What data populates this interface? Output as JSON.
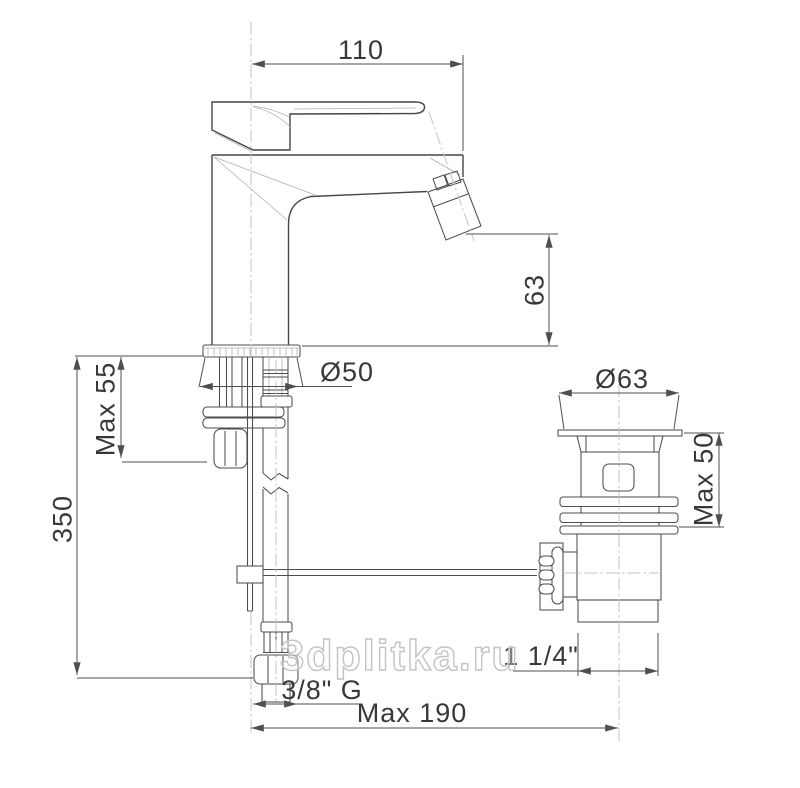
{
  "drawing": {
    "type": "technical-dimension-drawing",
    "subject": "single-lever bidet mixer with pop-up waste, side view"
  },
  "labels": {
    "handle_length": "110",
    "spout_height": "63",
    "base_diameter": "Ø50",
    "max_deck_thickness": "Max 55",
    "supply_height": "350",
    "waste_flange_diameter": "Ø63",
    "waste_max_height": "Max 50",
    "waste_thread": "1 1/4\"",
    "supply_thread": "3/8\" G",
    "max_axis_distance": "Max 190"
  },
  "watermark": {
    "text": "3dplitka.ru",
    "color": "#c3c3c3"
  },
  "colors": {
    "outline": "#474747",
    "dimension": "#4f4f4f",
    "construction": "#b0b0b0",
    "centerline": "#bfc6c9",
    "background": "#ffffff"
  }
}
